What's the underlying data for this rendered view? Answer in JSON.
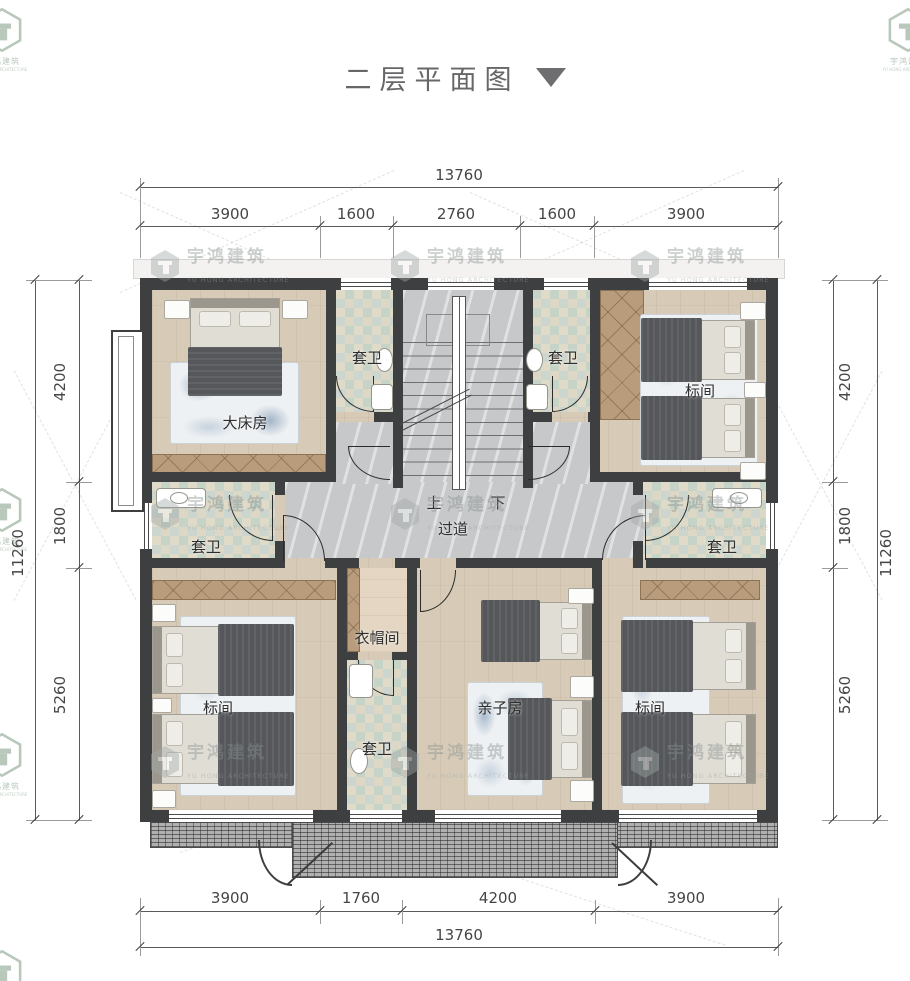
{
  "title": {
    "text": "二层平面图"
  },
  "watermark": {
    "cn": "宇鸿建筑",
    "en": "YU HONG ARCHITECTURE"
  },
  "dimensions": {
    "top_total": "13760",
    "top_segments": [
      "3900",
      "1600",
      "2760",
      "1600",
      "3900"
    ],
    "bottom_segments": [
      "3900",
      "1760",
      "4200",
      "3900"
    ],
    "bottom_total": "13760",
    "left_segments": [
      "4200",
      "1800",
      "5260"
    ],
    "left_total": "11260",
    "right_segments": [
      "4200",
      "1800",
      "5260"
    ],
    "right_total": "11260"
  },
  "rooms": {
    "master_bedroom": "大床房",
    "standard_room": "标间",
    "family_room": "亲子房",
    "ensuite_bath": "套卫",
    "cloakroom": "衣帽间",
    "corridor": "过道",
    "stair_up": "上",
    "stair_down": "下"
  },
  "colors": {
    "wall": "#3e3f40",
    "wood_floor": "#d7cbb8",
    "tile_a": "#c6d3c7",
    "tile_b": "#ddd8c6",
    "marble": "#c9cacc",
    "wardrobe": "#b89c7c",
    "blanket": "#55575a",
    "rug_blue": "#7c9cba",
    "dimension_text": "#454545",
    "title_text": "#67676a"
  }
}
